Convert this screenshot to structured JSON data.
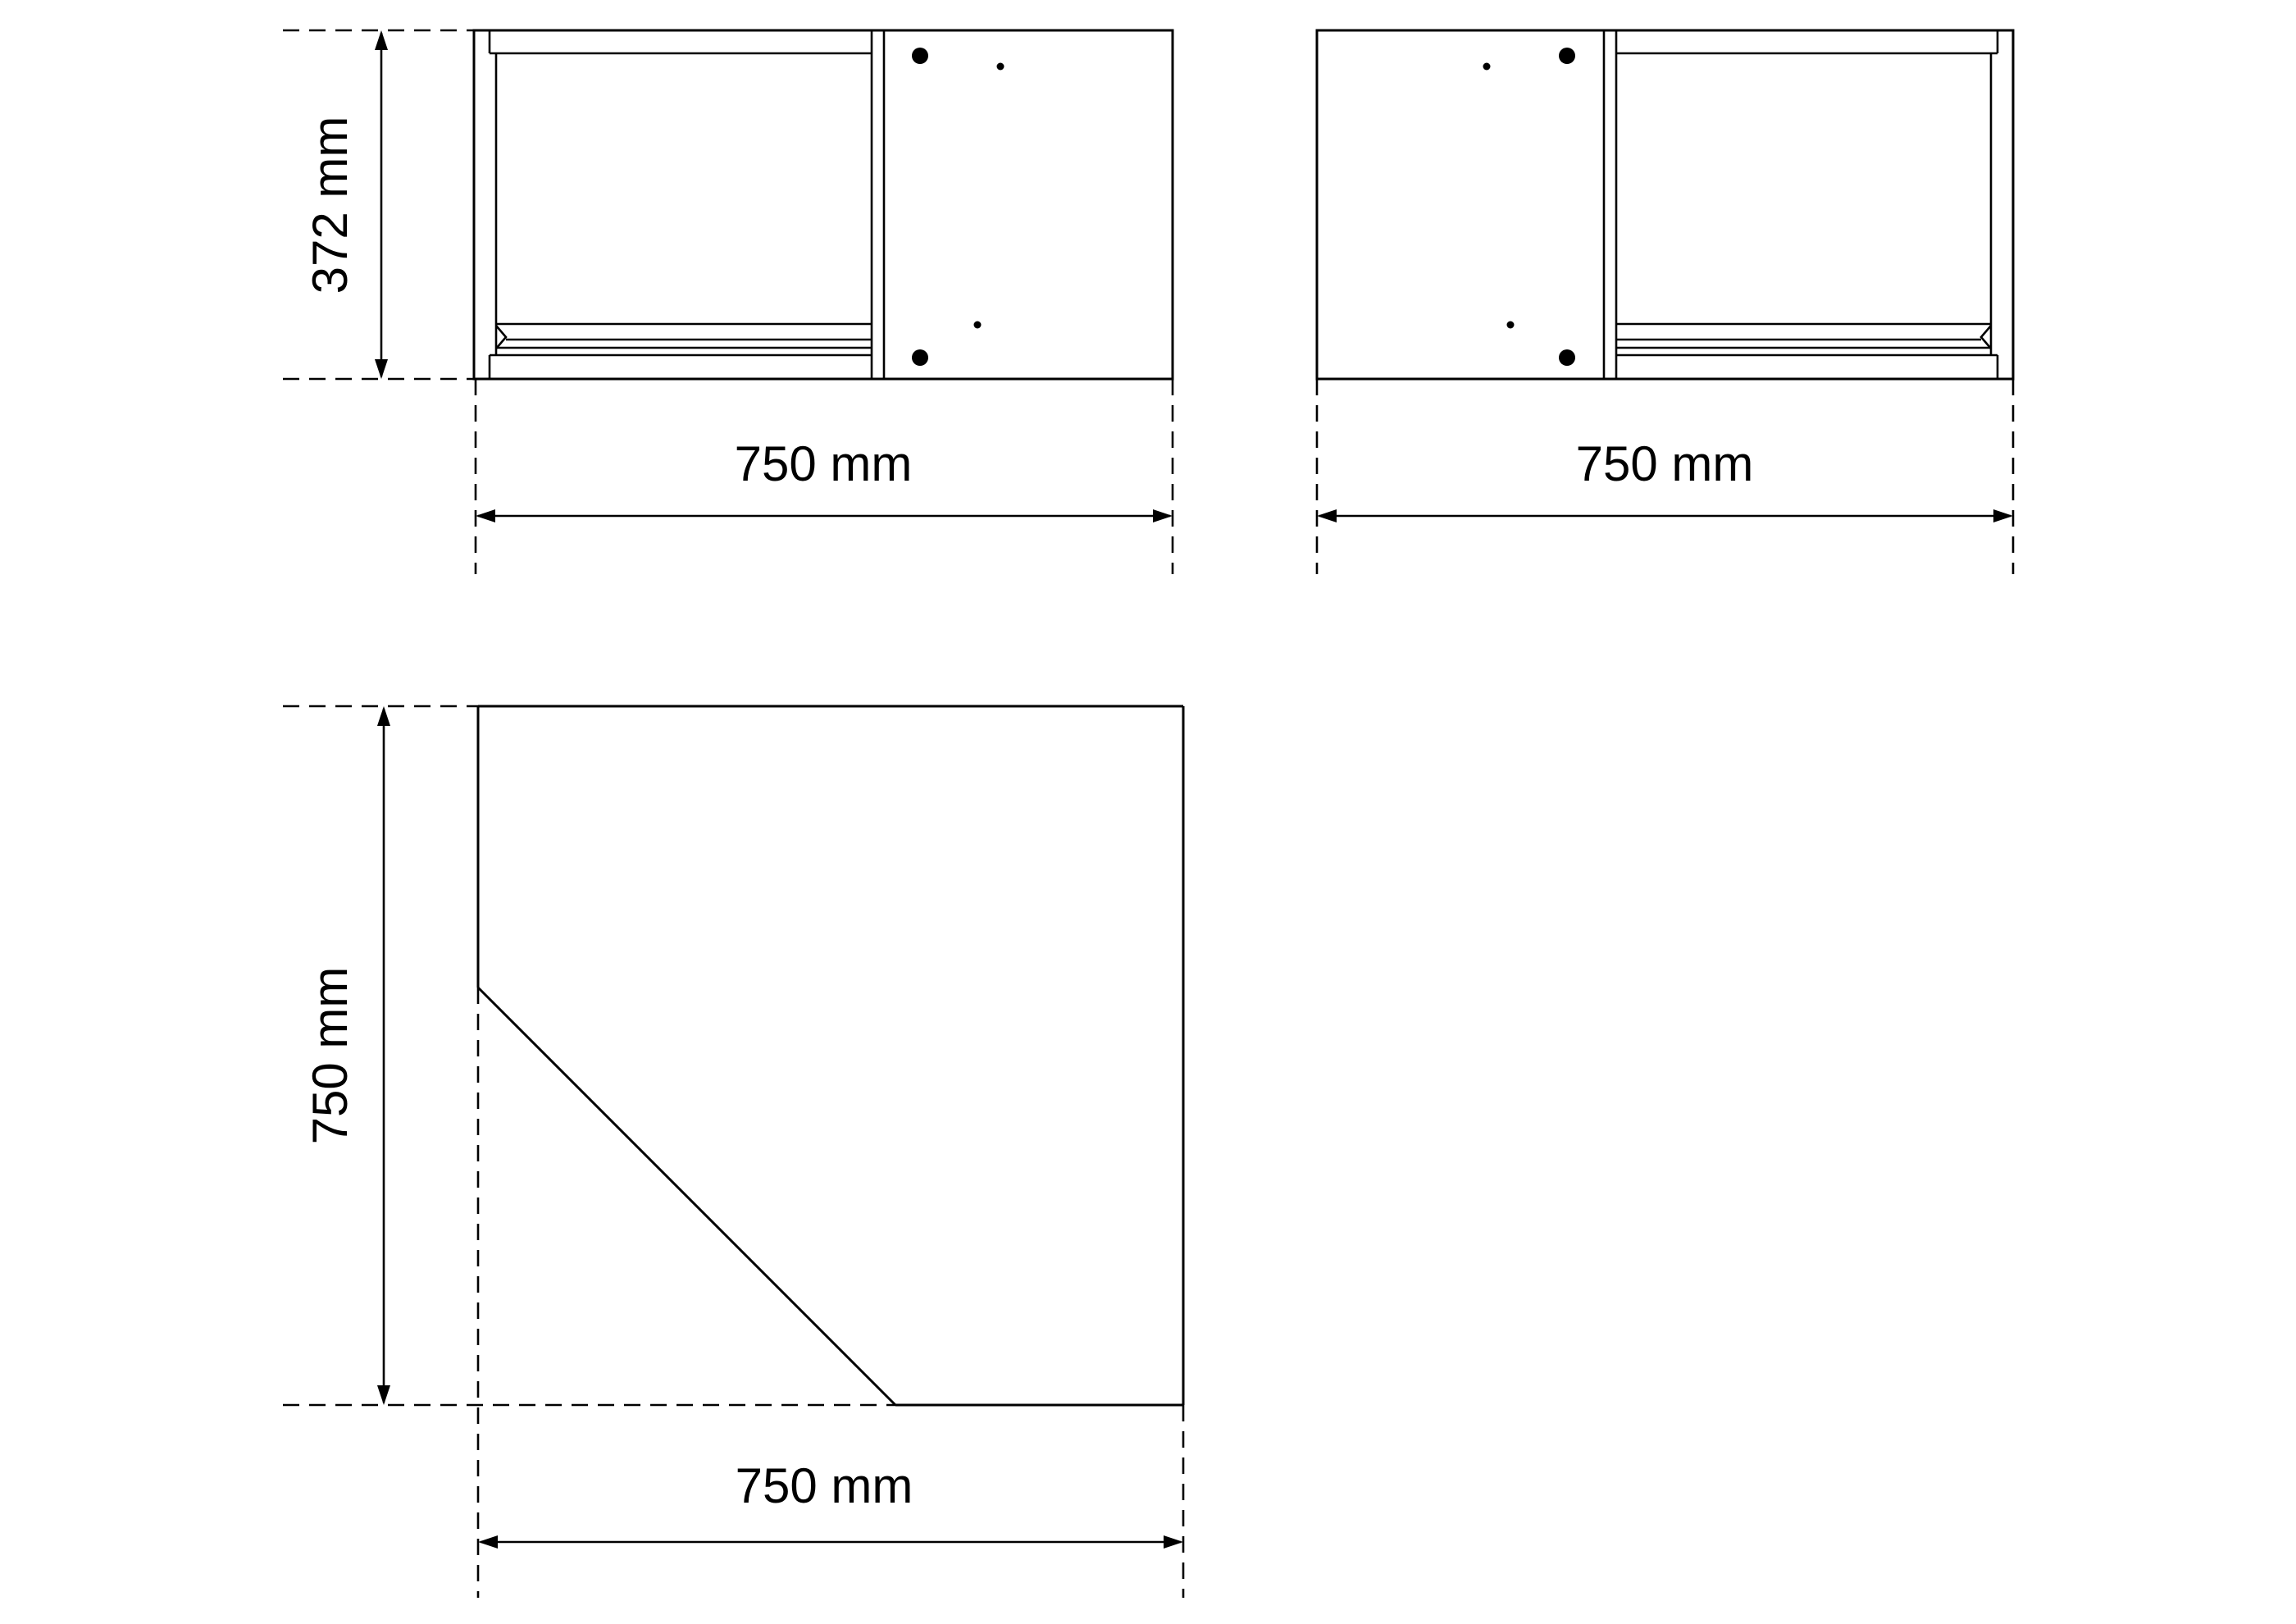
{
  "colors": {
    "background": "#ffffff",
    "line": "#000000"
  },
  "drawing": {
    "front_view_left": {
      "height_dimension": "372 mm",
      "width_dimension": "750 mm"
    },
    "front_view_right": {
      "width_dimension": "750 mm"
    },
    "plan_view": {
      "height_dimension": "750 mm",
      "width_dimension": "750 mm"
    }
  }
}
